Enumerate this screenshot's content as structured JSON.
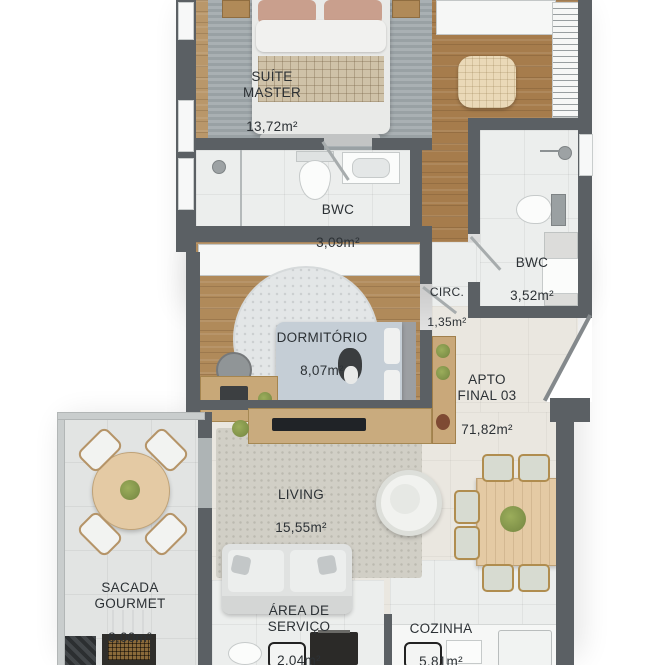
{
  "unit": {
    "label": "APTO\nFINAL 03",
    "area": "71,82m²"
  },
  "rooms": {
    "suite_master": {
      "label": "SUÍTE\nMASTER",
      "area": "13,72m²"
    },
    "bwc_suite": {
      "label": "BWC",
      "area": "3,09m²"
    },
    "bwc_social": {
      "label": "BWC",
      "area": "3,52m²"
    },
    "circ": {
      "label": "CIRC.",
      "area": "1,35m²"
    },
    "dormitorio": {
      "label": "DORMITÓRIO",
      "area": "8,07m²"
    },
    "living": {
      "label": "LIVING",
      "area": "15,55m²"
    },
    "sacada": {
      "label": "SACADA\nGOURMET",
      "area": "8,00m²"
    },
    "servico": {
      "label": "ÁREA DE\nSERVIÇO",
      "area": "2,04m²"
    },
    "cozinha": {
      "label": "COZINHA",
      "area": "5,81m²"
    }
  },
  "colors": {
    "wall": "#5b6064",
    "ink": "#2c3135",
    "wood_suite": "#b9976a",
    "wood_closet": "#a67c4c",
    "wood_dorm": "#b08a5a",
    "tile_white": "#eceeed",
    "tile_beige": "#eae7e0",
    "rug_suite": "#a3abae",
    "rug_living": "#d1cfc6",
    "rug_dorm": "#e3e6e7",
    "balcony_tile": "#e2e4e3",
    "table_wood": "#e4caa4",
    "plant_green": "#7f9148",
    "sofa": "#e0e2e1"
  }
}
